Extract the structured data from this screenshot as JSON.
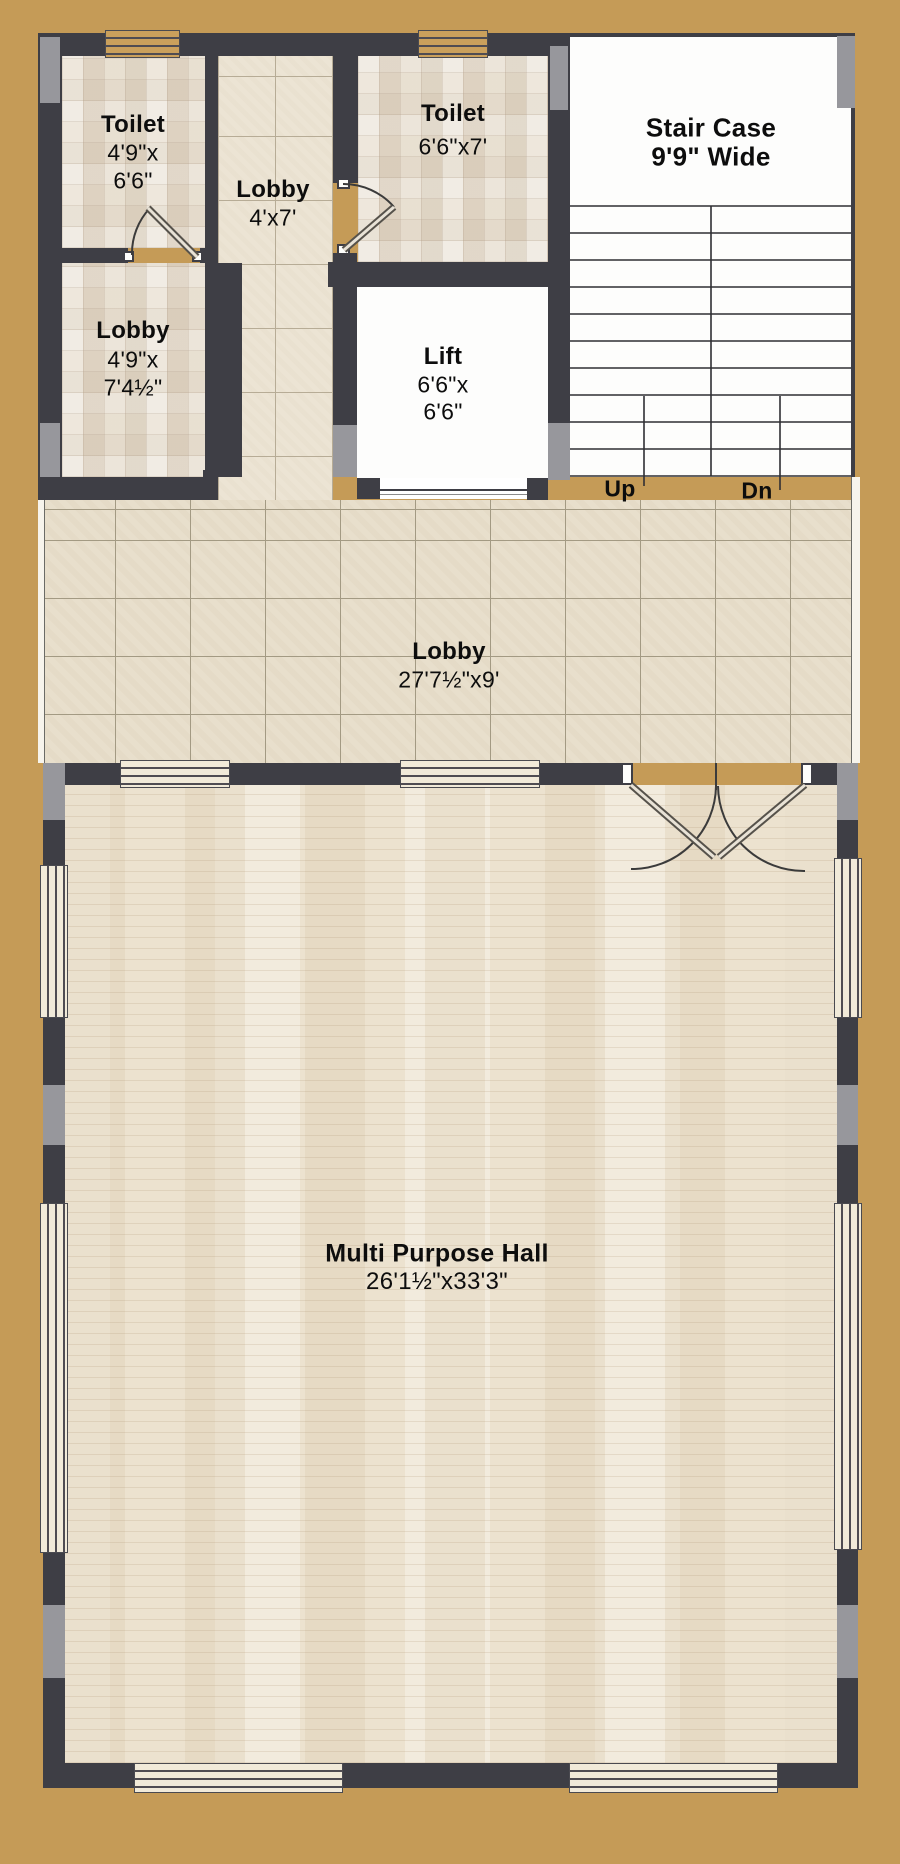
{
  "colors": {
    "background_tan": "#c59b57",
    "wall_dark": "#3e3e45",
    "wall_gray": "#97979c",
    "stair_lift_white": "#fdfdfc",
    "label_text": "#0d0d0d"
  },
  "rooms": {
    "toilet_top_left": {
      "name": "Toilet",
      "dim_line1": "4'9\"x",
      "dim_line2": "6'6\""
    },
    "lobby_corridor": {
      "name": "Lobby",
      "dim_line1": "4'x7'"
    },
    "toilet_top_right": {
      "name": "Toilet",
      "dim_line1": "6'6\"x7'"
    },
    "staircase": {
      "name": "Stair Case",
      "dim_line1": "9'9\" Wide"
    },
    "lobby_left": {
      "name": "Lobby",
      "dim_line1": "4'9\"x",
      "dim_line2": "7'4½\""
    },
    "lift": {
      "name": "Lift",
      "dim_line1": "6'6\"x",
      "dim_line2": "6'6\""
    },
    "lobby_main": {
      "name": "Lobby",
      "dim_line1": "27'7½\"x9'"
    },
    "multi_purpose_hall": {
      "name": "Multi Purpose Hall",
      "dim_line1": "26'1½\"x33'3\""
    }
  },
  "stair": {
    "up_label": "Up",
    "down_label": "Dn"
  }
}
